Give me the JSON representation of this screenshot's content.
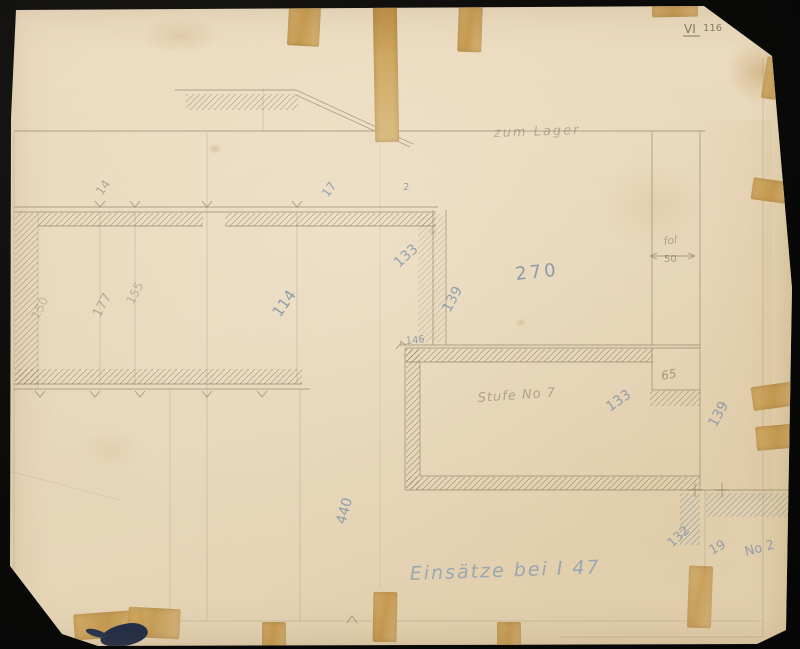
{
  "scene": {
    "description": "Aged hand-drawn floor plan sketch on yellowed paper with tape remnants, photographed on a black background"
  },
  "colors": {
    "paper": "#e8d9bf",
    "pencil": "#7b6d58",
    "blue_pencil": "#6e86a5",
    "tape": "#c99f56",
    "ink_blot": "#1f2b47",
    "backdrop": "#0a0a09"
  },
  "corner_mark": {
    "roman": "VI",
    "number": "116"
  },
  "notes": {
    "top_note": "zum Lager",
    "room_label": "Stufe No 7",
    "fol": "fol",
    "caption": "Einsätze bei I 47"
  },
  "dimensions": {
    "d270": "270",
    "d114": "114",
    "d133_left": "133",
    "d139_upper": "139",
    "d146": "146",
    "d50": "50",
    "d65": "65",
    "d133_room": "133",
    "d139_lower": "139",
    "d440": "440",
    "d132": "132",
    "d19": "19",
    "no2": "No 2",
    "d177": "177",
    "d155": "155",
    "d150": "150",
    "d14": "14",
    "d17": "17",
    "d2": "2"
  }
}
